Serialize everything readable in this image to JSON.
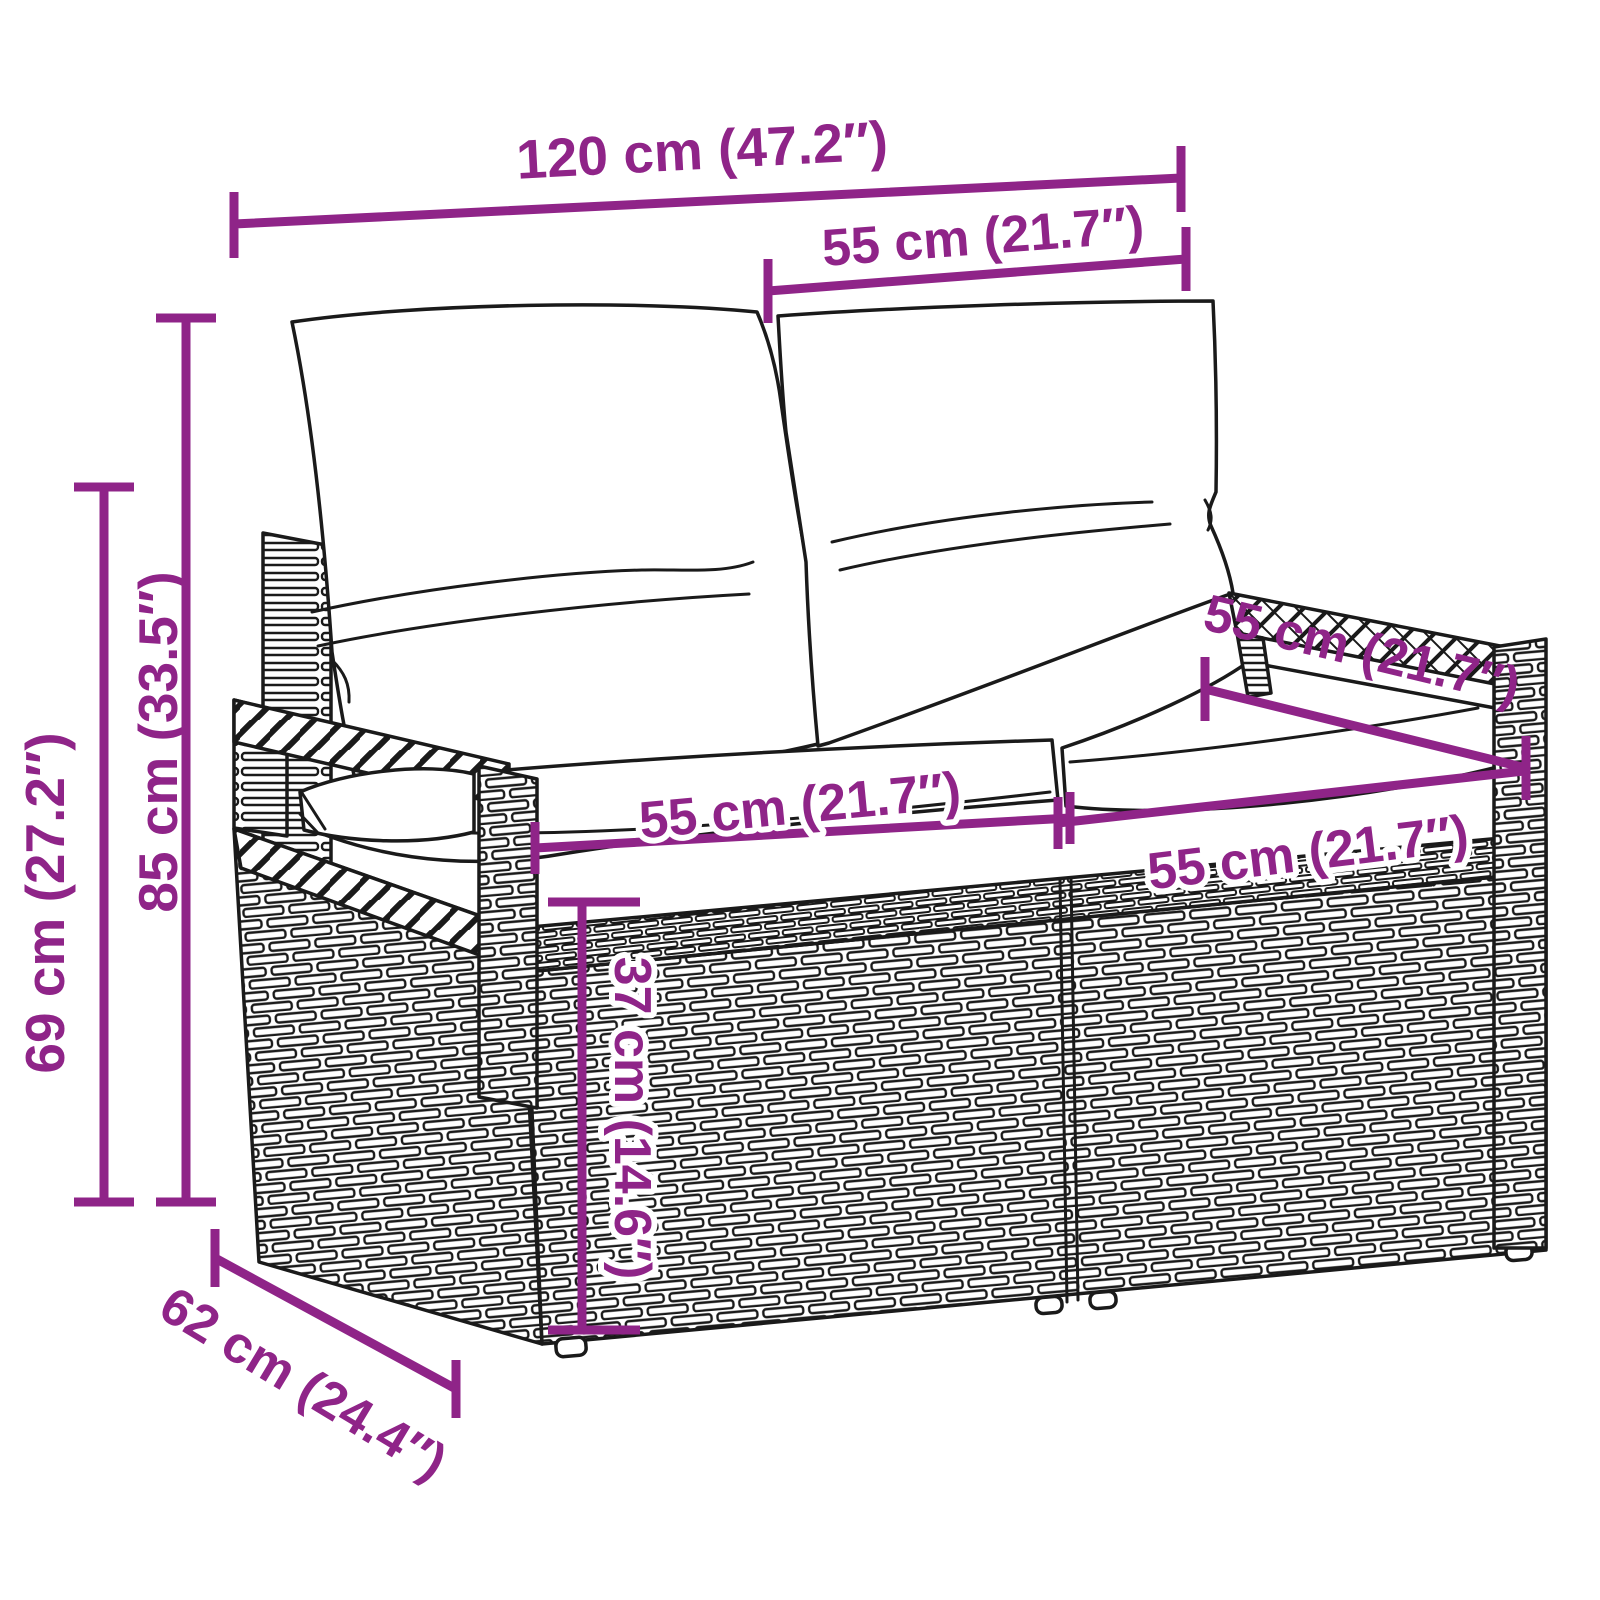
{
  "diagram": {
    "kind": "product-dimension-diagram",
    "subject": "poly rattan 2-seater garden bench with back and seat cushions",
    "background_color": "#ffffff",
    "line_art_color": "#1a1a1a",
    "accent_color": "#8F2488",
    "dimensions": {
      "overall_width": "120 cm (47.2″)",
      "back_cushion_width": "55 cm (21.7″)",
      "total_height": "85 cm (33.5″)",
      "frame_height": "69 cm (27.2″)",
      "seat_depth": "55 cm (21.7″)",
      "seat_width_left": "55 cm (21.7″)",
      "seat_width_right": "55 cm (21.7″)",
      "seat_height": "37 cm (14.6″)",
      "overall_depth": "62 cm (24.4″)"
    }
  }
}
